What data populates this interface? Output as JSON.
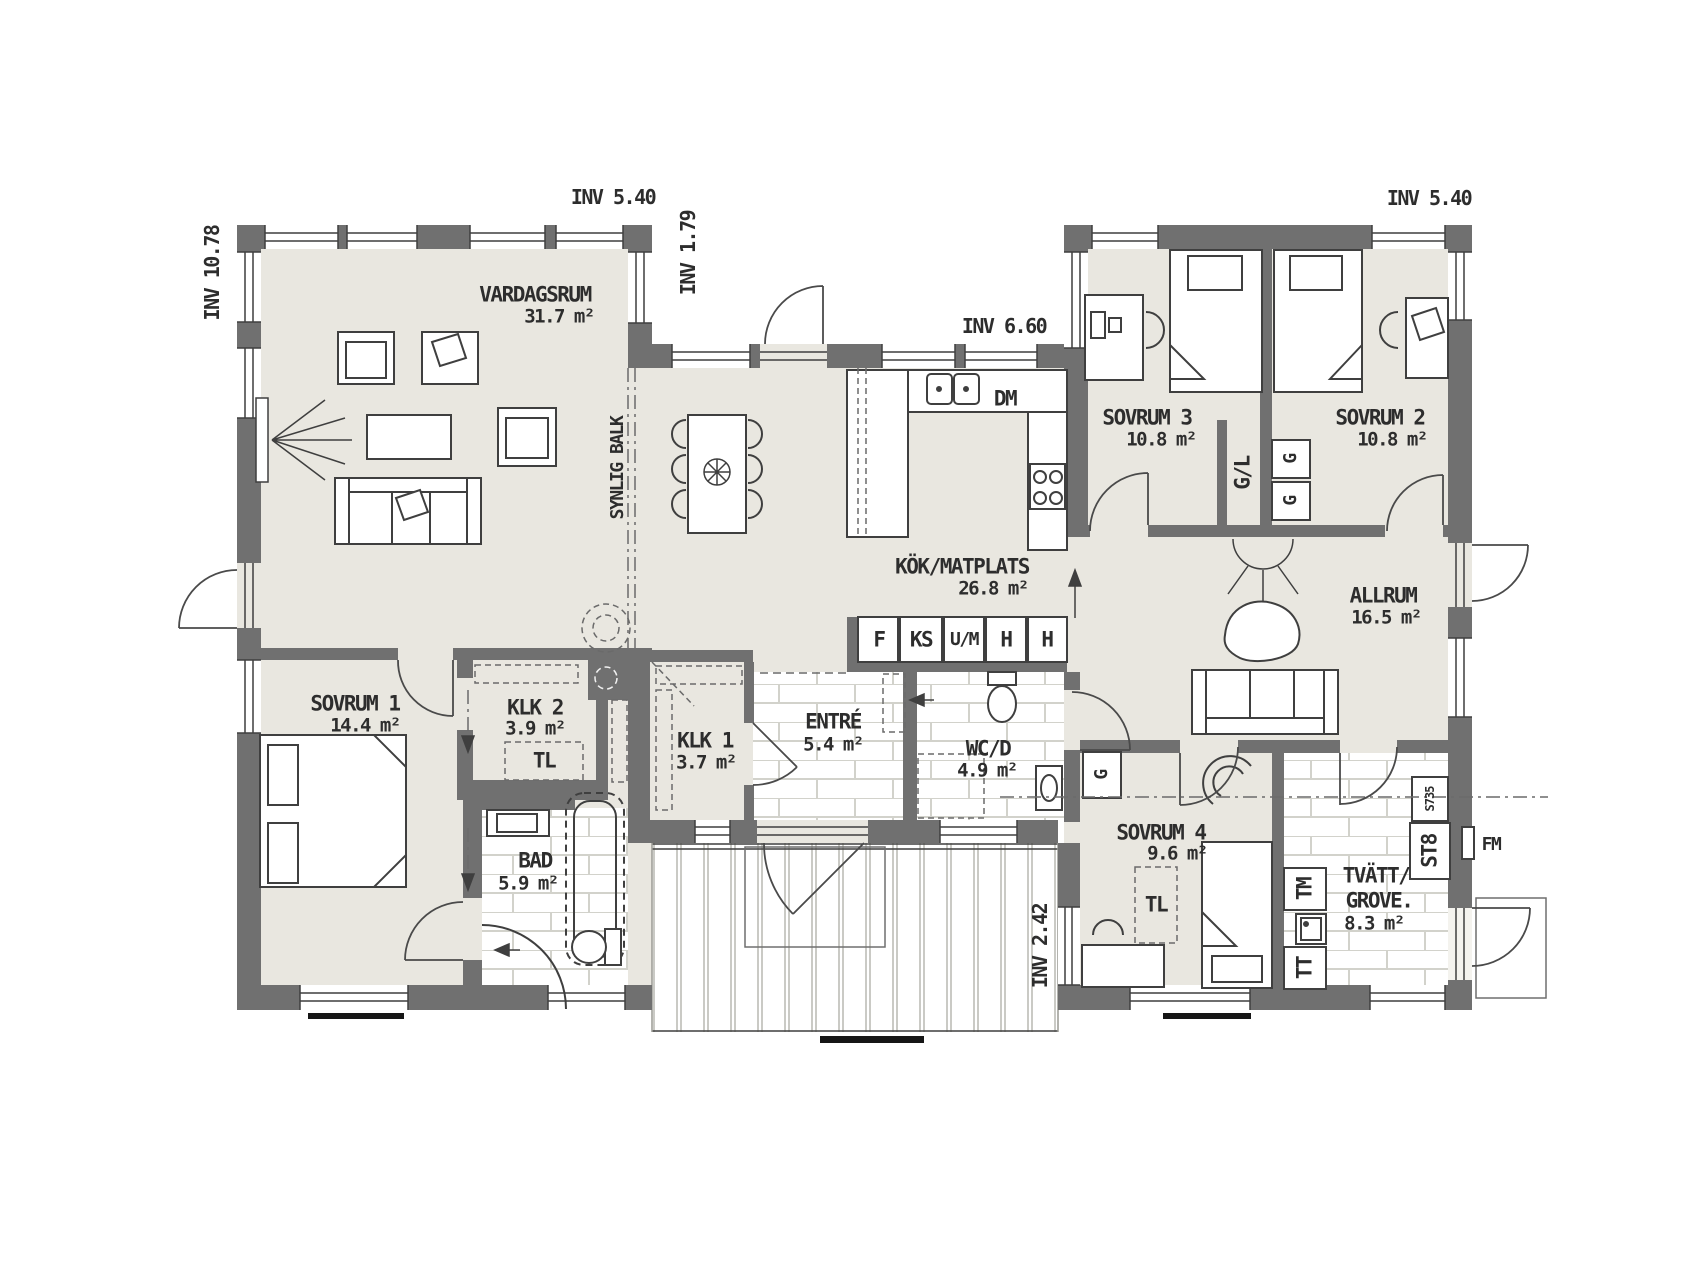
{
  "rooms": {
    "vardagsrum": {
      "name": "VARDAGSRUM",
      "area": "31.7 m²"
    },
    "kok": {
      "name": "KÖK/MATPLATS",
      "area": "26.8 m²"
    },
    "sovrum3": {
      "name": "SOVRUM 3",
      "area": "10.8 m²"
    },
    "sovrum2": {
      "name": "SOVRUM 2",
      "area": "10.8 m²"
    },
    "allrum": {
      "name": "ALLRUM",
      "area": "16.5 m²"
    },
    "sovrum1": {
      "name": "SOVRUM 1",
      "area": "14.4 m²"
    },
    "klk2": {
      "name": "KLK 2",
      "area": "3.9 m²"
    },
    "klk1": {
      "name": "KLK 1",
      "area": "3.7 m²"
    },
    "entre": {
      "name": "ENTRÉ",
      "area": "5.4 m²"
    },
    "wcd": {
      "name": "WC/D",
      "area": "4.9 m²"
    },
    "bad": {
      "name": "BAD",
      "area": "5.9 m²"
    },
    "sovrum4": {
      "name": "SOVRUM 4",
      "area": "9.6 m²"
    },
    "tvatt": {
      "name": "TVÄTT/",
      "name2": "GROVE.",
      "area": "8.3 m²"
    }
  },
  "measurements": {
    "left": "INV 10.78",
    "top_left": "INV 5.40",
    "notch": "INV 1.79",
    "middle": "INV 6.60",
    "top_right": "INV 5.40",
    "deck": "INV 2.42"
  },
  "items": {
    "beam": "SYNLIG BALK",
    "dm": "DM",
    "f": "F",
    "ks": "KS",
    "um": "U/M",
    "h1": "H",
    "h2": "H",
    "gl": "G/L",
    "g_s2a": "G",
    "g_s2b": "G",
    "g_hall": "G",
    "tl_klk2": "TL",
    "tl_s4": "TL",
    "tm": "TM",
    "tt": "TT",
    "st8": "ST8",
    "s735": "S735",
    "fm": "FM"
  },
  "colors": {
    "floor": "#e9e7e0",
    "wall": "#707070",
    "line": "#3f3f3f",
    "tile_line": "#d2d2cb"
  }
}
